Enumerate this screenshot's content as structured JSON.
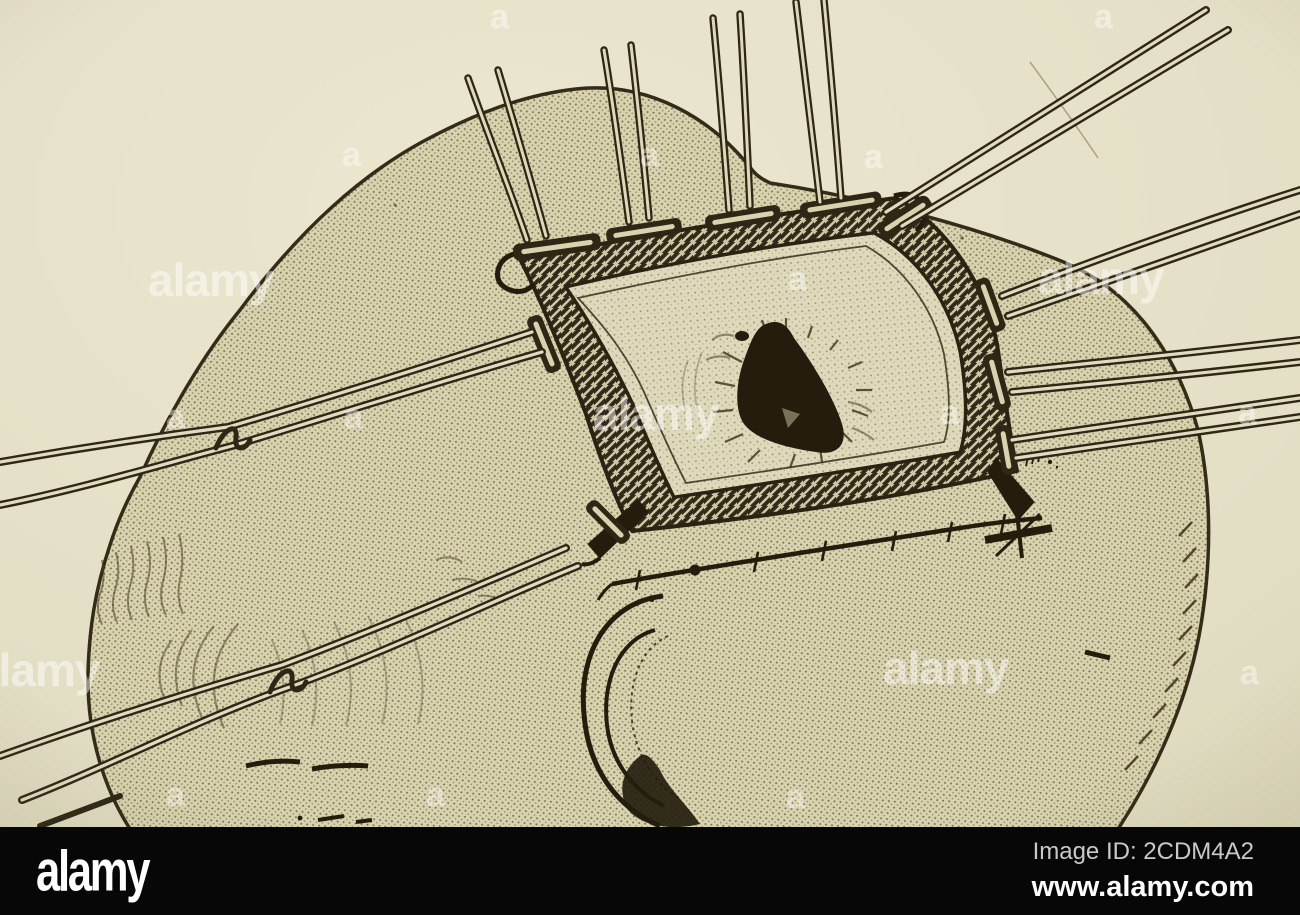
{
  "footer": {
    "logo": "alamy",
    "image_id": "Image ID: 2CDM4A2",
    "website": "www.alamy.com"
  },
  "watermark": {
    "word": "alamy",
    "letter": "a"
  },
  "colors": {
    "paper": "#e4e0c7",
    "scalp_tone": "#d8d2ae",
    "ink": "#2e2715",
    "footer_bar": "#070707",
    "footer_text": "#ffffff",
    "image_id_text": "#c9c9c9",
    "watermark": "#ffffff"
  }
}
